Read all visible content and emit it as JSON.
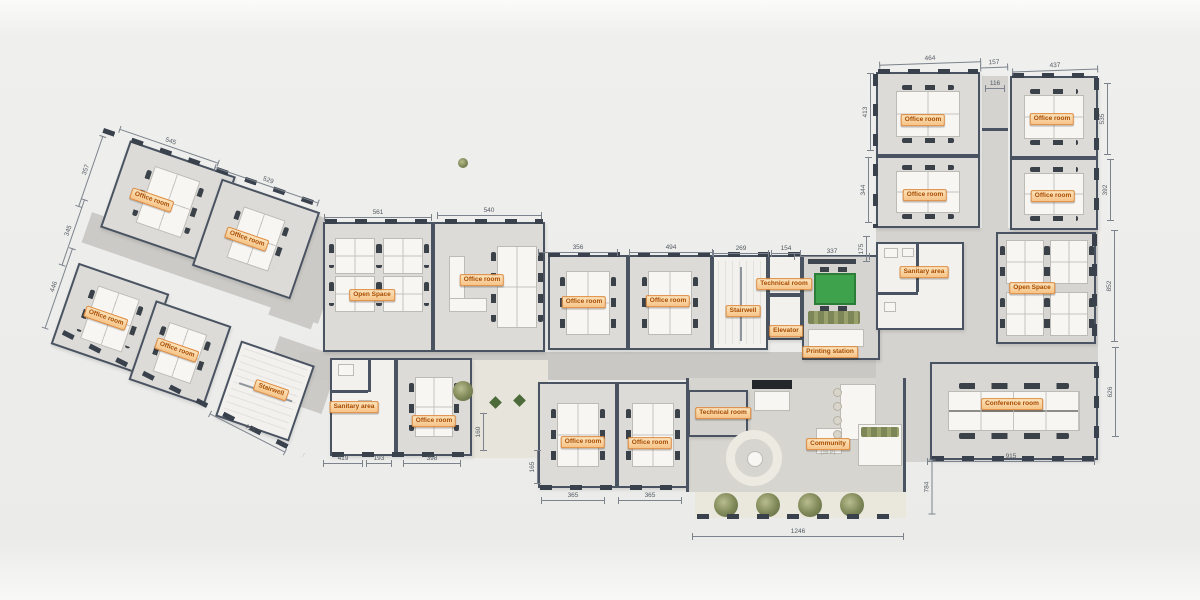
{
  "scene": "office-floor-plan",
  "colors": {
    "wall": "#4a5361",
    "floor_room": "#dcdbd7",
    "floor_corridor": "#c9c8c4",
    "floor_light": "#f2f1ee",
    "label_bg": "#f6c488",
    "label_border": "#e08a3c",
    "label_text": "#a84b00",
    "green_table": "#3da24b",
    "plant_olive": "#7d8656",
    "dim_text": "#555b63"
  },
  "room_labels": [
    {
      "t": "Office room",
      "x": 152,
      "y": 200,
      "r": 19
    },
    {
      "t": "Office room",
      "x": 247,
      "y": 239,
      "r": 19
    },
    {
      "t": "Office room",
      "x": 106,
      "y": 318,
      "r": 19
    },
    {
      "t": "Office room",
      "x": 177,
      "y": 350,
      "r": 19
    },
    {
      "t": "Stairwell",
      "x": 271,
      "y": 390,
      "r": 19
    },
    {
      "t": "Open Space",
      "x": 372,
      "y": 295,
      "r": 0
    },
    {
      "t": "Office room",
      "x": 482,
      "y": 280,
      "r": 0
    },
    {
      "t": "Sanitary area",
      "x": 354,
      "y": 407,
      "r": 0
    },
    {
      "t": "Office room",
      "x": 434,
      "y": 421,
      "r": 0
    },
    {
      "t": "Office room",
      "x": 584,
      "y": 302,
      "r": 0
    },
    {
      "t": "Office room",
      "x": 668,
      "y": 301,
      "r": 0
    },
    {
      "t": "Stairwell",
      "x": 743,
      "y": 311,
      "r": 0
    },
    {
      "t": "Technical room",
      "x": 784,
      "y": 284,
      "r": 0
    },
    {
      "t": "Elevator",
      "x": 786,
      "y": 331,
      "r": 0
    },
    {
      "t": "Printing station",
      "x": 830,
      "y": 352,
      "r": 0
    },
    {
      "t": "Technical room",
      "x": 723,
      "y": 413,
      "r": 0
    },
    {
      "t": "Office room",
      "x": 583,
      "y": 442,
      "r": 0
    },
    {
      "t": "Office room",
      "x": 650,
      "y": 443,
      "r": 0
    },
    {
      "t": "Community",
      "x": 828,
      "y": 444,
      "r": 0
    },
    {
      "t": "(16 P)",
      "x": 828,
      "y": 453,
      "r": 0,
      "sub": true
    },
    {
      "t": "Sanitary area",
      "x": 924,
      "y": 272,
      "r": 0
    },
    {
      "t": "Open Space",
      "x": 1032,
      "y": 288,
      "r": 0
    },
    {
      "t": "Office room",
      "x": 923,
      "y": 120,
      "r": 0
    },
    {
      "t": "Office room",
      "x": 1052,
      "y": 119,
      "r": 0
    },
    {
      "t": "Office room",
      "x": 925,
      "y": 195,
      "r": 0
    },
    {
      "t": "Office room",
      "x": 1053,
      "y": 196,
      "r": 0
    },
    {
      "t": "Conference room",
      "x": 1012,
      "y": 404,
      "r": 0
    }
  ],
  "dimensions": [
    {
      "t": "545",
      "x": 170,
      "y": 142,
      "r": 19,
      "l": 105
    },
    {
      "t": "529",
      "x": 268,
      "y": 181,
      "r": 19,
      "l": 110
    },
    {
      "t": "357",
      "x": 86,
      "y": 170,
      "r": -71,
      "l": 75
    },
    {
      "t": "345",
      "x": 69,
      "y": 231,
      "r": -71,
      "l": 70
    },
    {
      "t": "446",
      "x": 54,
      "y": 287,
      "r": -71,
      "l": 85
    },
    {
      "t": "415",
      "x": 249,
      "y": 429,
      "r": 27,
      "l": 85
    },
    {
      "t": "561",
      "x": 378,
      "y": 213,
      "r": 0,
      "l": 108
    },
    {
      "t": "540",
      "x": 489,
      "y": 211,
      "r": 0,
      "l": 105
    },
    {
      "t": "356",
      "x": 578,
      "y": 248,
      "r": 0,
      "l": 80
    },
    {
      "t": "494",
      "x": 671,
      "y": 248,
      "r": 0,
      "l": 84
    },
    {
      "t": "269",
      "x": 741,
      "y": 249,
      "r": 0,
      "l": 56
    },
    {
      "t": "154",
      "x": 786,
      "y": 249,
      "r": 0,
      "l": 30
    },
    {
      "t": "337",
      "x": 832,
      "y": 252,
      "r": 0,
      "l": 76
    },
    {
      "t": "175",
      "x": 862,
      "y": 249,
      "r": -90,
      "l": 26
    },
    {
      "t": "464",
      "x": 930,
      "y": 59,
      "r": -2,
      "l": 102
    },
    {
      "t": "157",
      "x": 994,
      "y": 63,
      "r": -2,
      "l": 28
    },
    {
      "t": "437",
      "x": 1055,
      "y": 66,
      "r": -2,
      "l": 86
    },
    {
      "t": "116",
      "x": 995,
      "y": 84,
      "r": 0,
      "l": 20
    },
    {
      "t": "413",
      "x": 866,
      "y": 112,
      "r": -90,
      "l": 78
    },
    {
      "t": "344",
      "x": 864,
      "y": 190,
      "r": -90,
      "l": 66
    },
    {
      "t": "535",
      "x": 1103,
      "y": 119,
      "r": -90,
      "l": 72
    },
    {
      "t": "392",
      "x": 1106,
      "y": 190,
      "r": -90,
      "l": 62
    },
    {
      "t": "852",
      "x": 1110,
      "y": 286,
      "r": -90,
      "l": 112
    },
    {
      "t": "626",
      "x": 1111,
      "y": 392,
      "r": -90,
      "l": 90
    },
    {
      "t": "915",
      "x": 1011,
      "y": 457,
      "r": 0,
      "l": 168
    },
    {
      "t": "784",
      "x": 927,
      "y": 487,
      "r": -90,
      "l": 55
    },
    {
      "t": "1246",
      "x": 798,
      "y": 532,
      "r": 0,
      "l": 212
    },
    {
      "t": "419",
      "x": 343,
      "y": 459,
      "r": 0,
      "l": 40
    },
    {
      "t": "193",
      "x": 379,
      "y": 459,
      "r": 0,
      "l": 26
    },
    {
      "t": "398",
      "x": 432,
      "y": 459,
      "r": 0,
      "l": 58
    },
    {
      "t": "160",
      "x": 479,
      "y": 432,
      "r": -90,
      "l": 38
    },
    {
      "t": "165",
      "x": 533,
      "y": 467,
      "r": -90,
      "l": 34
    },
    {
      "t": "365",
      "x": 573,
      "y": 496,
      "r": 0,
      "l": 64
    },
    {
      "t": "365",
      "x": 650,
      "y": 496,
      "r": 0,
      "l": 64
    }
  ]
}
